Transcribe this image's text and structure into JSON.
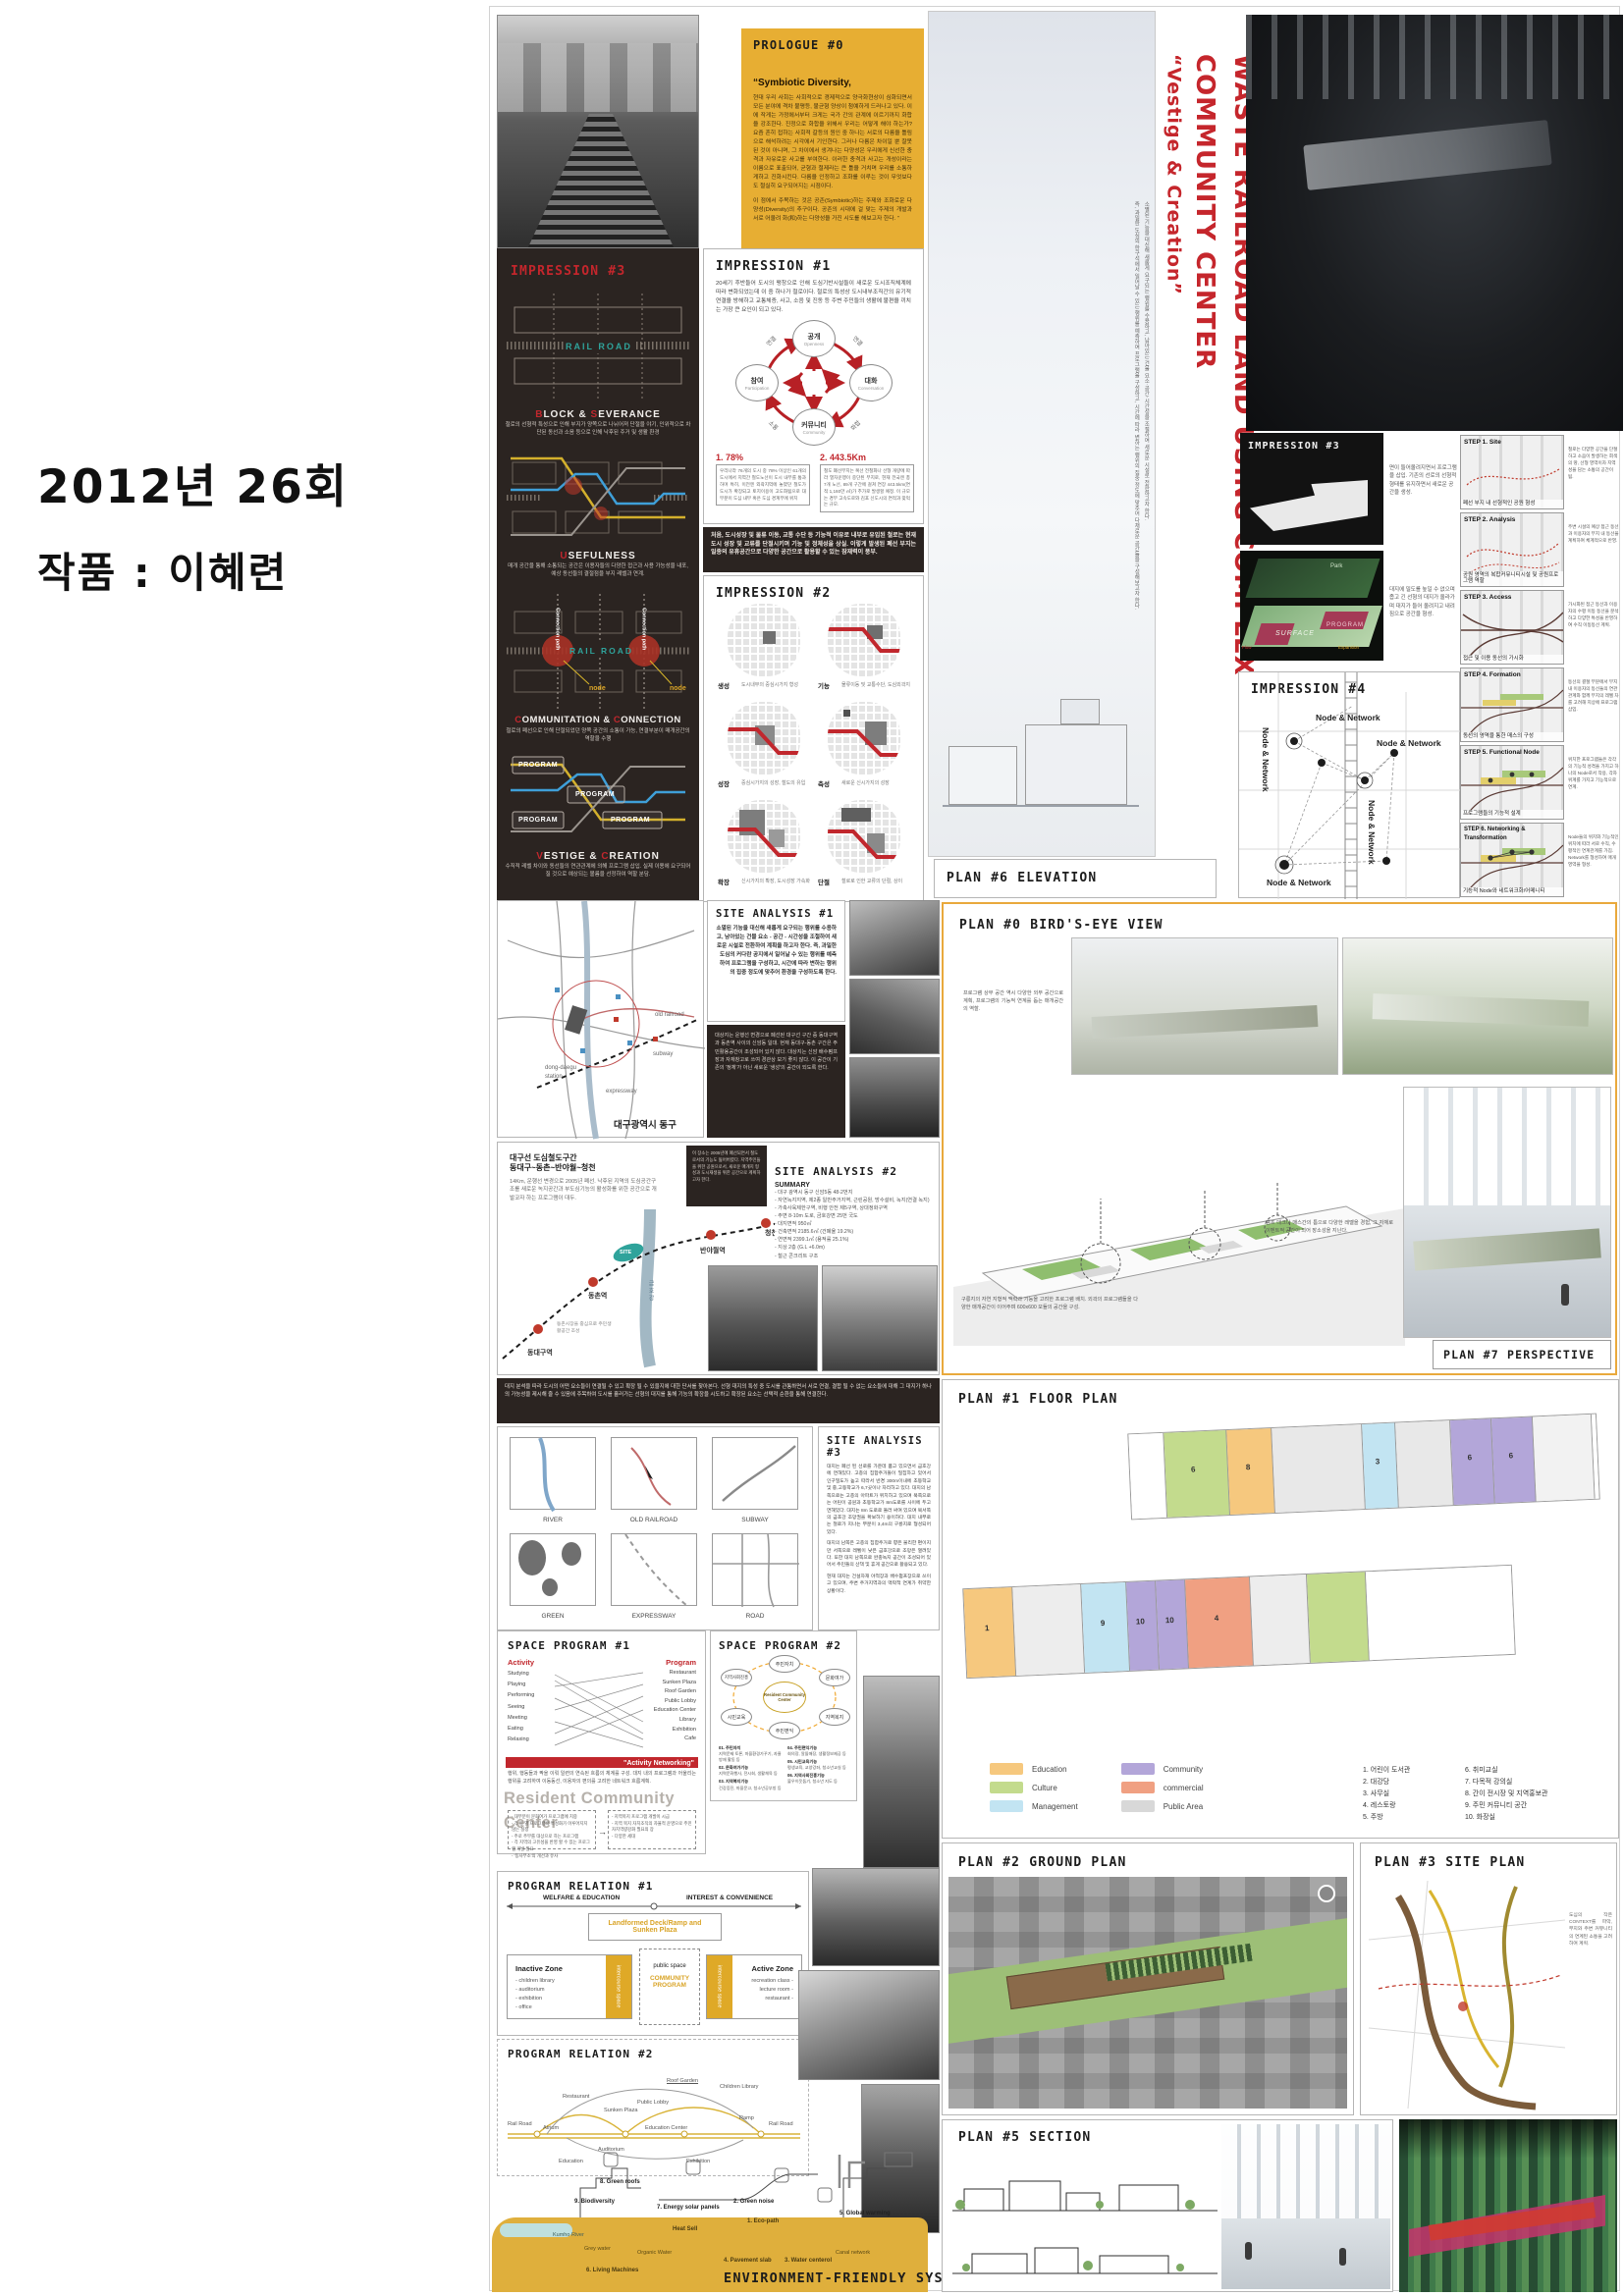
{
  "meta": {
    "year": "2012년 26회",
    "work": "작품 : 이혜련"
  },
  "title": {
    "main": "WASTE RAILROAD LAND USING COMPLEX COMMUNITY CENTER",
    "sub": "“Vestige & Creation”",
    "note1": "소멸된 기능을 대신해 새롭게 요구되는 행위를 수용하고, 남아있는 건물 요소·공간·시간성을 조절하여 새로운 시설로 전환하고자 한다.",
    "note2": "즉, 과밀한 도심의 한구석에서 일어날 수 있는 행위를 예측하여 프로그램을 구성하고, 시간에 따라 변하는 행위의 집중 정도에 맞추어 다채로운 공간들을 구성해보고자 한다."
  },
  "prologue": {
    "title": "PROLOGUE #0",
    "quote": "“Symbiotic Diversity,",
    "p1": "현대 우리 사회는 사회적으로 경제적으로 양극화현상이 심화되면서 모든 분야에 격차 불평등, 불균형 양상이 첨예하게 드러나고 있다. 이에 작게는 가정에서부터 크게는 국가 간의 관계에 이르기까지 화합을 강조한다. 진정으로 화합을 위해서 우리는 어떻게 해야 하는가?  요즘 흔히 접하는 사회적 갈등의 원인 중 하나는 서로의 다름을 틀림으로 해석하려는 시각에서 기인한다. 그러나 다름은 차이일 뿐 잘못된 것이 아니며, 그 차이에서 생겨나는 다양성은 우리에게 신선한 충격과 자유로운 사고를 부여한다. 이러한 충격과 사고는 개성이라는 이름으로 표출되어, 균형과 절제라는 큰 틀을 거치며 우리를 소통하게하고 진화시킨다. 다름을 인정하고 조화를 이루는 것이 무엇보다도 절실히 요구되어지는 시점이다.",
    "p2": "이 점에서 주목하는 것은 공존(Symbiotic)하는 주제와 조화로운 다양성(Diversity)의 추구이다. 공존의 시대에 걸 맞는 주제의 개발과 서로 어울려 화(和)하는 다양성을 가진 시도를 해보고자 한다. ”"
  },
  "impression1": {
    "title": "IMPRESSION #1",
    "intro": "20세기 후반들어 도시의 팽창으로 인해 도심기반시설들이 새로운 도시조직체계에 따라 변화되었는데 이 중 하나가 철로이다. 철로의 특성상 도시내부조직간의 유기적 연결을 방해하고 교통체증, 사고, 소음 및 진동 등 주변 주민들의 생활에 불편을 끼치는 가장 큰 요인이 되고 있다.",
    "nodes": {
      "top": "공개",
      "top_en": "Openness",
      "right": "대화",
      "right_en": "Conversation",
      "bottom": "커뮤니티",
      "bottom_en": "Community",
      "left": "참여",
      "left_en": "Participation"
    },
    "edges": [
      "연결",
      "연결",
      "소통",
      "화합"
    ],
    "stats": [
      {
        "label": "1. 78%",
        "text": "우리나라 76개의 도시 중 78% 이상인 61개의 도시에서 지역간 철도노선이 도시 내부를 통과하며 특히, 이전엔 외곽지역에 놓였던 철도가 도시가 확장되고 토지이용이 고도화됨으로 대부분이 도심 내부 혹은 도심 경계부에 위치"
      },
      {
        "label": "2. 443.5Km",
        "text": "철도 폐선부지는 복선 전철화나 선형 개량에 따라 열차운행이 중단된 부지로, 현재 전국엔 총 7개 노선, 89개 구간에 걸쳐 연장 443.5km(면적 1,160만 ㎡)가 추가로 발생할 예정. 이 규모는 경부 고속도로와 김포 신도시의 면적과 맞먹는 규모."
      },
      {
        "label": "3. TRACK",
        "text": "우리나라 76개의 도시 중 78% 이상인 61개의 도시에서 지역간 철도노선이 도시 내부를 통과하며 특히, 이전엔 외곽지역에 놓였던 철도가 도시가 확장되고 토지이용이 고도화됨으로 대부분이 도심 내부 혹은 도심 경계부에 위치"
      }
    ]
  },
  "note_bar": "처음, 도시성장 및 물류 이동, 교통 수단 등 기능적 이유로 내부로 유입된 철로는 현재 도시 성장 및 교류를 단절시키며 기능 및 정체성을 상실. 이렇게 발생된 폐선 부지는 일종의 유휴공간으로 다양한 공간으로 활용할 수 있는 잠재력이 풍부.",
  "impression2": {
    "title": "IMPRESSION #2",
    "cells": [
      {
        "l": "생성",
        "c": "도시내부의 중심시가지 형성"
      },
      {
        "l": "기능",
        "c": "물류이동 및 교통수단, 도심외곽지"
      },
      {
        "l": "성장",
        "c": "중심시가지의 성장, 철도의 유입"
      },
      {
        "l": "축성",
        "c": "새로운 신시가지의 성장"
      },
      {
        "l": "확장",
        "c": "신시가지의 확장, 도시성장 가속화"
      },
      {
        "l": "단절",
        "c": "철로로 인한 교류의 단절, 상이"
      }
    ]
  },
  "impression3L": {
    "title": "IMPRESSION #3",
    "rail": "RAIL ROAD",
    "cpath": "Connection path",
    "node": "node",
    "program": "PROGRAM",
    "s1h": [
      "B",
      "LOCK & ",
      "S",
      "EVERANCE"
    ],
    "s1t": "철로의 선형적 특성으로 인해 부지가 양쪽으로 나뉘어져 단절을 야기, 인위적으로 차단된 동선과 소음 등으로 인해 낙후된 주거 및 생활 환경",
    "s2h": [
      "U",
      "SEFULNESS"
    ],
    "s2t": "매개 공간을 통해 소통되는 공간은 이용자들의 다양한 접근과 사용 가능성을 내포, 예상 동선들의 결절점을 부지 레벨과 연계.",
    "s3h": [
      "C",
      "OMMUNITATION & ",
      "C",
      "ONNECTION"
    ],
    "s3t": "철로의 폐선으로 인해 단절되었던 양쪽 공간의 소통이 가능, 연결부분이 매개공간의 역할을 수행",
    "s4h": [
      "V",
      "ESTIGE & ",
      "C",
      "REATION"
    ],
    "s4t": "수직적 레벨 차이와 동선들의 연관관계에 의해 프로그램 삽입. 실제 이용에 요구되어질 것으로 예상되는 볼륨을 선정하여 역할 분담."
  },
  "impression3R": {
    "title": "IMPRESSION #3",
    "cap1": "면이 들어올려지면서 프로그램을 삽입. 기존의 선로의 선형적 형태를 유지하면서 새로운 공간을 생성.",
    "cap2": "대지에 밀도를 높일 수 없으며 좁고 긴 선형의 대지가 올라가며 대지가 들어 올려지고 내려짐으로 공간을 형성.",
    "park": "Park",
    "surface": "SURFACE",
    "program": "PROGRAM",
    "expansion": "Expansion",
    "flow": "Flow"
  },
  "impression4": {
    "title": "IMPRESSION #4",
    "node": "Node & Network"
  },
  "steps": [
    {
      "title": "STEP 1. Site",
      "caption": "폐선 부지 내 선형적인 공원 형성",
      "note": "철로는 다양한 공간을 단절하고 소음이 발생하는 회색의 땅, 선형 영역이자 지역성을 담는 소통의 공간이 됨."
    },
    {
      "title": "STEP 2. Analysis",
      "caption": "공원 영역의 복합커뮤니티시설 및 공원프로그램 역할",
      "note": "주변 시설의 예상 접근 동선과 이용자의 부지 내 동선을 계획하여 체계적으로 반영."
    },
    {
      "title": "STEP 3. Access",
      "caption": "접근 및 이용 동선의 가시화",
      "note": "가시화된 접근 동선과 이용자의 수평 이동 동선을 분석하고 다양한 특성을 반영하여 수직 이동동선 계획."
    },
    {
      "title": "STEP 4. Formation",
      "caption": "동선의 영역을 통한 매스의 구성",
      "note": "동선의 결절 부분에서 부지 내 이용자의 동선들의 연관관계와 함께 부지의 레벨 차를 고려해 지상에 프로그램 삽입."
    },
    {
      "title": "STEP 5. Functional Node",
      "caption": "프로그램들의 기능적 설계",
      "note": "위치한 프로그램들은 각각의 기능적 성격을 가지고 하나의 Node로서 작용, 각자 위계를 가지고 기능적으로 연계."
    },
    {
      "title": "STEP 6. Networking & Transformation",
      "caption": "기능적 Node와 네트워크화/어메니티",
      "note": "Node들의 위치와 기능적인 위치에 따라 서로 수직, 수평적인 연계관계를 가짐. Network를 형성하여 매개영역을 형성."
    }
  ],
  "sa1": {
    "title": "SITE ANALYSIS #1",
    "text": "소멸된 기능을 대신해 새롭게 요구되는 행위를 수용하고, 남아있는 건물 요소 - 공간 - 시간성을 조절하여 새로운 시설로 전환하여 계획을 하고자 한다. 즉, 과밀한 도심의 커다란 공지에서 일어날 수 있는 행위를 예측하여 프로그램을 구성하고, 시간에 따라 변하는 행위의 집중 정도에 맞추어 환경을 구성하도록 한다.",
    "dark_text": "대상지는 운행선 변경으로 폐선된 대구선 구간 중 동대구역과 동촌역 사이의 신암동 일대. 현재 동대구-동촌 구간은 주민활용공간이 조성되어 있지 않다. 대상지는 신암 배수펌프장과 자재창고로 쓰여 경관상 보기 좋지 않다. 이 공간이 기존의 '정체'가 아닌 새로운 '생성'의 공간이 되도록 한다.",
    "labels": {
      "old_railroad": "old railroad",
      "station": "dong-daegu station",
      "subway": "subway",
      "expressway": "expressway"
    },
    "map_caption": "대구광역시 동구"
  },
  "sa2": {
    "title": "SITE ANALYSIS #2",
    "heading": "대구선 도심철도구간",
    "heading2": "동대구~동촌~반야월~청천",
    "desc": "14Km, 운행선 변경으로 2005년 폐선. 낙후된 지역의 도심공간구조를 새로운 녹지공간과 부도심기능의 활성화를 위한 공간으로 개발코자 하는 프로그램이 대두.",
    "dark_text": "이 장소는 2005년에 폐선되면서 철도로서의 기능도 잃어버렸다. 지역주민들을 위한 공원으로서, 새로운 매개지 형성과 도시재생을 위한 공간으로 계획하고자 한다.",
    "stations": [
      "동대구역",
      "동촌역",
      "반야월역",
      "청천"
    ],
    "site": "SITE",
    "river": "금 호 강",
    "note": "동촌시장을 중심으로 주민생활공간 조성",
    "summary_title": "SUMMARY",
    "summary": [
      "- 대구 광역시 동구 신암5동 48-2번지",
      "- 자연녹지지역, 제2종 일반주거지역, 근린공원, 방수설비, 녹지(연결 녹지)",
      "- 가축사육제한구역, 비행 안전 제5구역, 상대정화구역",
      "- 주변 8-10m 도로, 금호강변 25번 국도",
      "- 대지면적 950㎡",
      "- 건축면적 2185.6㎡ (건폐율 19.2%)",
      "- 연면적 2399.1㎡ (용적률 25.1%)",
      "- 지상 2층 (G.L +6.0m)",
      "- 철근 콘크리트 구조"
    ]
  },
  "sa3": {
    "title": "SITE ANALYSIS #3",
    "bar": "대지 분석을 따라 도시의 어떤 요소들이 연결될 수 있고 확장 될 수 있을지에 대한 단서를 찾아본다. 선형 대지의 특성 중 도시를 관통하면서 서로 연결, 결합 될 수 없는 요소들에 대해 그 대지가 하나의 가능성을 제시해 줄 수 있음에 주목하여 도시를 흘러가는 선형의 대지를 통해 기능의 확장을 시도하고 확장된 요소는 선택적 순환을 통해 연결한다.",
    "thumbs": [
      "RIVER",
      "OLD RAILROAD",
      "SUBWAY",
      "GREEN",
      "EXPRESSWAY",
      "ROAD"
    ],
    "p1": "대지는 폐선 된 선로를 가운데 품고 있으면서 금호강에 면해있다. 고층의 집합주거들이 밀집하고 있어서 인구밀도가 높고 따라서 반경 300m이내에 초등학교 및 중,고등학교가 6,7곳이나 자리하고 있다. 대지의 남쪽으로는 고층의 아파트가 위치하고 있으며 북쪽으로는 어린이 공원과 초등학교가 8m도로를 사이에 두고 면해있다. 대지는 8m 도로로 둘러 싸여 있으며 북서쪽의 금호강 조망권을 확보하기 용이하다. 대지 내부로는 철로가 지나는 부분이 3,4m의 구릉지로 형성되어 있다.",
    "p2": "대지의 남쪽은 고층의 집합주거로 향은 불리한 편이지만 서쪽으로 레벨이 낮은 금호강으로 조망은 열려있다. 또한 대지 남쪽으로 완충녹지 공간이 조성되어 있어서 주민들의 산책 및 휴게 공간으로 활용되고 있다.",
    "p3": "현재 대지는 건설자재 야적장과 배수펌프장으로 쓰이고 있으며, 주변 주거지역과의 맥락적 연계가 취약한 상황이다."
  },
  "sp1": {
    "title": "SPACE PROGRAM #1",
    "act_h": "Activity",
    "prog_h": "Program",
    "activities": [
      "Studying",
      "Playing",
      "Performing",
      "Seeing",
      "Meeting",
      "Eating",
      "Relaxing"
    ],
    "programs": [
      "Restaurant",
      "Sunken Plaza",
      "Roof Garden",
      "Public Lobby",
      "Education Center",
      "Library",
      "Exhibition",
      "Cafe"
    ],
    "banner": "\"Activity Networking\"",
    "caption": "행위, 행동들과 짝을 이뤄 일련의 연속된 흐름의 체계를 구성. 대지 내의 프로그램과 어울리는 행위를 고려하여 이동동선, 이용자의 편의를 고려한 네트워크 흐름계획.",
    "big": "Resident Community Center",
    "box1": [
      "- 대부분이 문화여가 프로그램에 치중",
      "- 각 동 별 프로그램의 특성화가 이루어지지 않는 실정",
      "- 주로 주부를 대상으로 하는 프로그램",
      "- 각 지역의 고유성을 반영 할 수 있는 프로그램 개발 필요",
      "- '동사무소'의 개선과 유사"
    ],
    "box2": [
      "- 지역복지 프로그램 개발이 시급",
      "- 지역 복지 자치조직의 자율적 운영으로 주민자치역량강화 필요의 장",
      "- 다양한 세대"
    ]
  },
  "sp2": {
    "title": "SPACE PROGRAM #2",
    "center": "Resident Community Center",
    "nodes": [
      "주민자치",
      "문화여가",
      "지역복지",
      "주민편익",
      "시민교육",
      "지역사회진흥"
    ],
    "items": [
      {
        "h": "01. 주민자치",
        "t": "지역문제 토론, 마을환경가꾸기, 자율방재 활동 등"
      },
      {
        "h": "02. 문화여가기능",
        "t": "지역문화행사, 전시회, 생활체육 등"
      },
      {
        "h": "03. 지역복지기능",
        "t": "건강증진, 마을문고, 청소년공부방 등"
      },
      {
        "h": "04. 주민편익기능",
        "t": "회의장, 알뜰매장, 생활정보제공 등"
      },
      {
        "h": "05. 시민교육기능",
        "t": "평생교육, 교양강좌, 청소년교실 등"
      },
      {
        "h": "06. 지역사회진흥기능",
        "t": "불우이웃돕기, 청소년 지도 등"
      }
    ]
  },
  "pr1": {
    "title": "PROGRAM RELATION #1",
    "axis_l": "WELFARE & EDUCATION",
    "axis_r": "INTEREST & CONVENIENCE",
    "top_box": "Landformed Deck/Ramp and Sunken Plaza",
    "inactive_h": "Inactive Zone",
    "inactive": [
      "- children library",
      "- auditorium",
      "- exhibition",
      "- office"
    ],
    "inter": "intercourse space",
    "public": "public space",
    "community": "COMMUNITY PROGRAM",
    "active_h": "Active Zone",
    "active": [
      "recreation class -",
      "lecture room -",
      "restaurant -"
    ]
  },
  "pr2": {
    "title": "PROGRAM RELATION #2",
    "labels": [
      "Rail Road",
      "Atrium",
      "Restaurant",
      "Sunken Plaza",
      "Public Lobby",
      "Education Center",
      "Roof Garden",
      "Children Library",
      "Ramp",
      "Rail Road",
      "Auditorium",
      "Education",
      "Exhibition"
    ]
  },
  "env": {
    "title": "ENVIRONMENT-FRIENDLY SYSTEM #0",
    "labels": {
      "l1": "1. Eco-path",
      "l2": "2. Green noise",
      "l3": "3. Water centerol",
      "l4": "4. Pavement slab",
      "l5": "5. Global warming",
      "l6": "6. Living Machines",
      "l7": "7. Energy solar panels",
      "l8": "8. Green roofs",
      "l9": "9. Biodiversity",
      "heat": "Heat Sell",
      "river": "Kumho River",
      "grey": "Grey water",
      "organic": "Organic Water",
      "canal": "Canal network"
    }
  },
  "plans": {
    "p6": "PLAN #6 ELEVATION",
    "p0": "PLAN #0 BIRD'S-EYE VIEW",
    "p0c1": "프로그램 상부 공간 역시 다양한 외부 공간으로 계획, 프로그램의 기능적 연계를 돕는 매개공간의 역할.",
    "p0c2": "램프 데크나 매스간의 틈으로 다양한 레벨을 경험, 그 자체로 이벤트적 공간이 되어 장소성을 지닌다.",
    "p0c3": "구릉지의 자연 지형적 맥락과 기능을 고려한 프로그램 배치. 외곽의 프로그램들을 다양한 매개공간이 이어주며 600x600 모듈의 공간을 구성.",
    "p7": "PLAN #7 PERSPECTIVE",
    "p1": "PLAN #1 FLOOR PLAN",
    "p2": "PLAN #2 GROUND PLAN",
    "p3": "PLAN #3 SITE PLAN",
    "p3c": "도심의 작은 CONTEXT를 파악, 부지와 주변 커뮤니티의 연계된 소통을 고려하여 계획.",
    "p5": "PLAN #5 SECTION",
    "mk": [
      "8",
      "6",
      "6",
      "3",
      "1",
      "9",
      "10",
      "10",
      "4"
    ]
  },
  "legend": [
    {
      "label": "Education",
      "color": "#F6C87E"
    },
    {
      "label": "Culture",
      "color": "#C3DB8D"
    },
    {
      "label": "Management",
      "color": "#C2E4F2"
    },
    {
      "label": "Community",
      "color": "#B3A6D9"
    },
    {
      "label": "commercial",
      "color": "#F0A082"
    },
    {
      "label": "Public Area",
      "color": "#D8D8D8"
    }
  ],
  "rooms_col1": [
    "1. 어린이 도서관",
    "2. 대강당",
    "3. 사무실",
    "4. 레스토랑",
    "5. 주방"
  ],
  "rooms_col2": [
    "6. 취미교실",
    "7. 다목적 강의실",
    "8. 간이 전시장 및 지역홍보관",
    "9. 주민 커뮤니티 공간",
    "10. 화장실"
  ]
}
